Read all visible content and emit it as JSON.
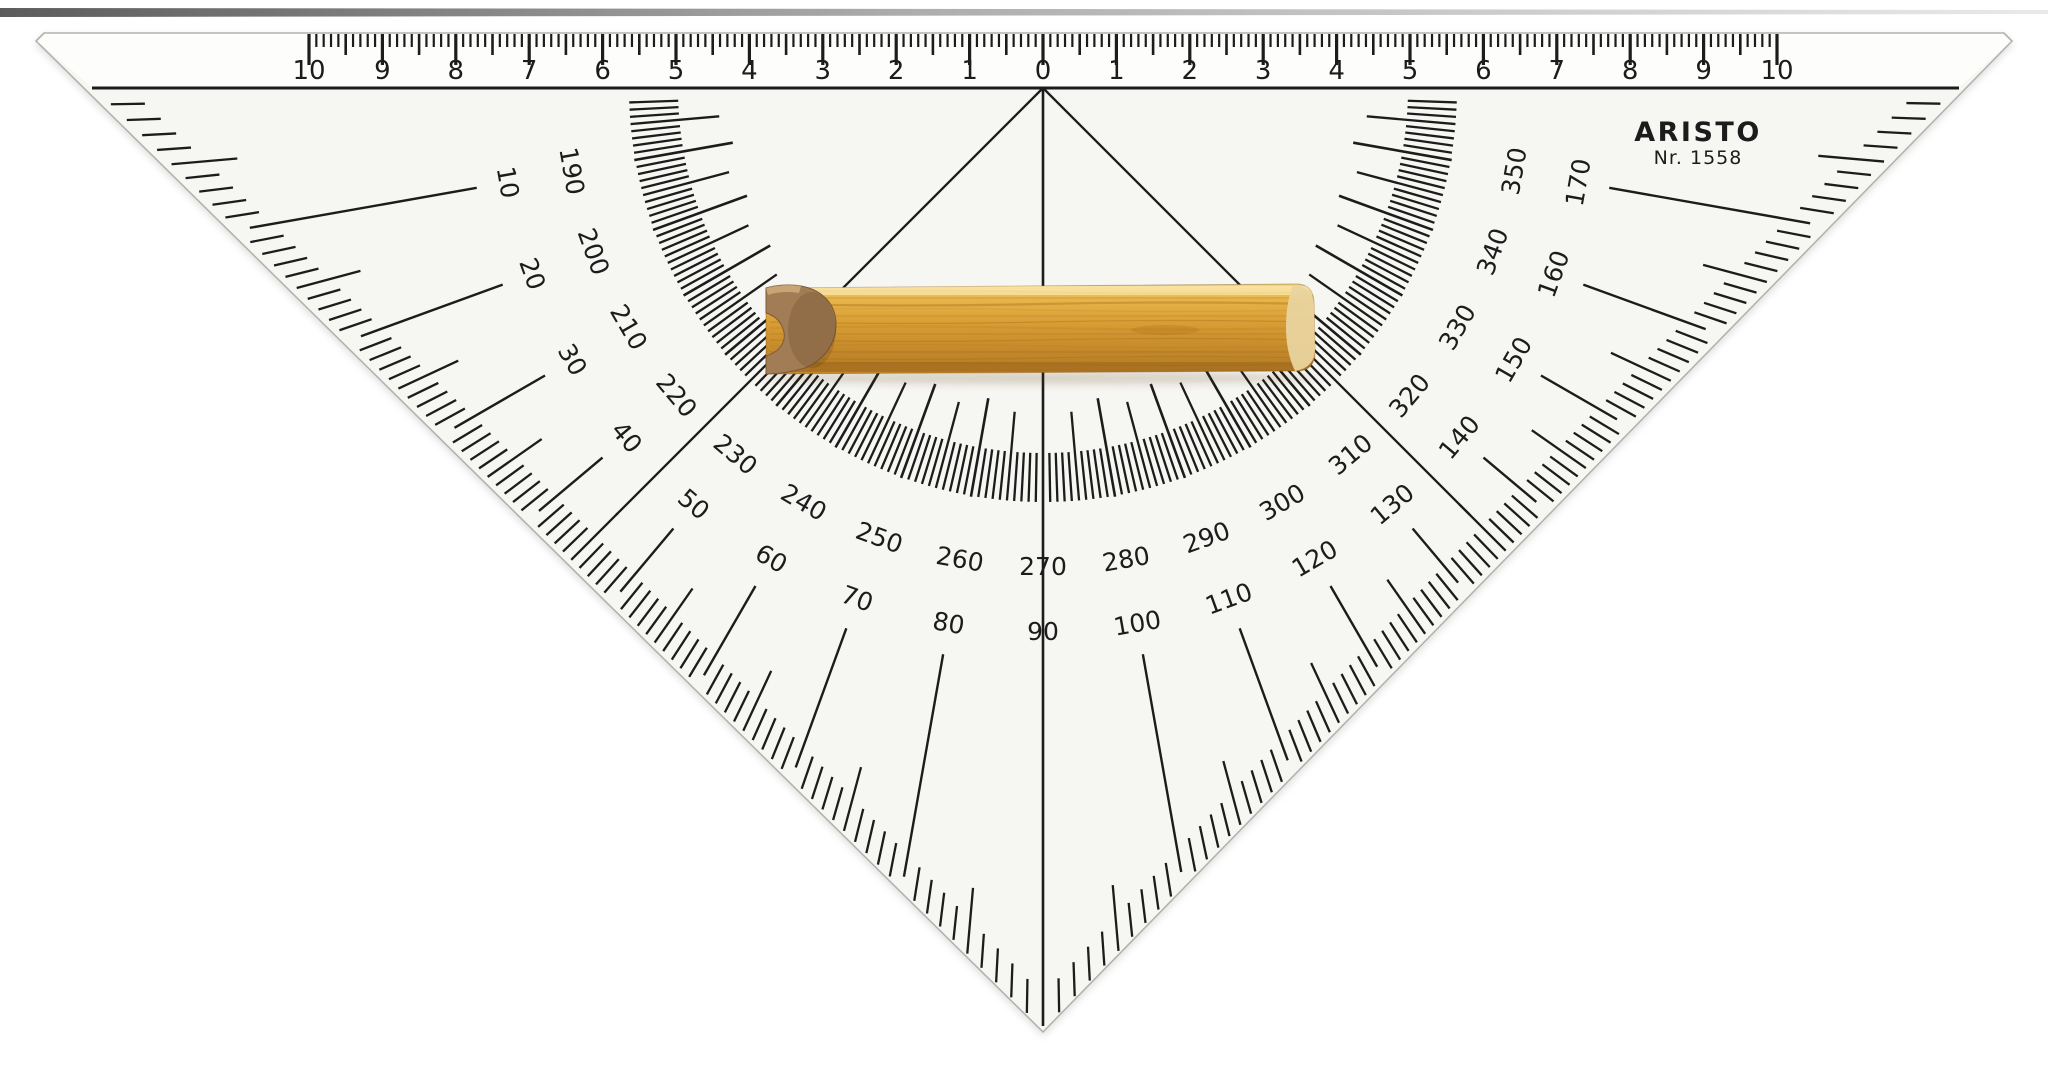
{
  "photo_subject": "Transparent nautical protractor set square (course plotting triangle) with a wooden handle, lying on a white background",
  "brand": {
    "name": "ARISTO",
    "model": "Nr. 1558"
  },
  "ruler": {
    "numbers": [
      "10",
      "9",
      "8",
      "7",
      "6",
      "5",
      "4",
      "3",
      "2",
      "1",
      "0",
      "1",
      "2",
      "3",
      "4",
      "5",
      "6",
      "7",
      "8",
      "9",
      "10"
    ],
    "units_per_side": 10,
    "minor_ticks_per_unit": 10
  },
  "protractor": {
    "outer_labels": [
      "10",
      "20",
      "30",
      "40",
      "50",
      "60",
      "70",
      "80",
      "90",
      "100",
      "110",
      "120",
      "130",
      "140",
      "150",
      "160",
      "170"
    ],
    "inner_labels": [
      "190",
      "200",
      "210",
      "220",
      "230",
      "240",
      "250",
      "260",
      "270",
      "280",
      "290",
      "300",
      "310",
      "320",
      "330",
      "340",
      "350"
    ],
    "outer_scale_range_deg": [
      0,
      180
    ],
    "inner_scale_range_deg": [
      180,
      360
    ],
    "fine_tick_step_deg": 1,
    "medium_tick_step_deg": 5,
    "labeled_step_deg": 10,
    "guide_line_angles_deg": [
      45,
      90,
      135
    ]
  },
  "colors": {
    "background": "#ffffff",
    "plastic_face": "#f6f6f3",
    "ruler_face": "#fdfdfc",
    "ink": "#1c1c1c",
    "edge_line": "#b3b3ac",
    "wood_light": "#f2d57e",
    "wood_mid": "#e7b64a",
    "wood_deep": "#d79c33",
    "wood_dark": "#c4892a",
    "wood_grain": "#a96f1e",
    "wood_end_face": "#e9d49e",
    "wood_profile_face": "#a27c54",
    "wood_profile_shadow": "#7c5a3c",
    "photo_edge": "#4a4a4a"
  }
}
